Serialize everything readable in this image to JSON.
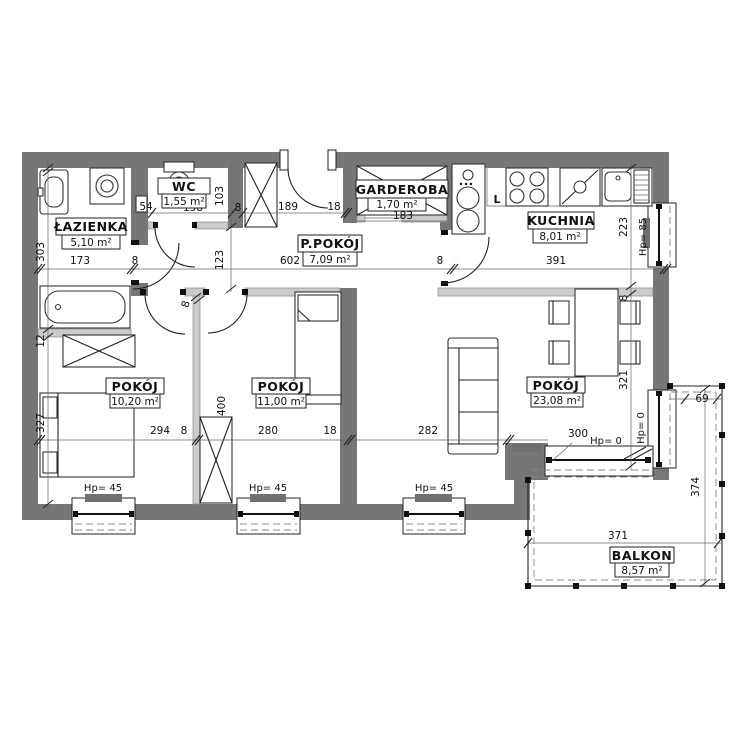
{
  "rooms": {
    "lazienka": {
      "name": "ŁAZIENKA",
      "area": "5,10 m²"
    },
    "wc": {
      "name": "WC",
      "area": "1,55 m²"
    },
    "garderoba": {
      "name": "GARDEROBA",
      "area": "1,70 m²"
    },
    "ppokoj": {
      "name": "P.POKÓJ",
      "area": "7,09 m²"
    },
    "kuchnia": {
      "name": "KUCHNIA",
      "area": "8,01 m²"
    },
    "pokoj1": {
      "name": "POKÓJ",
      "area": "10,20 m²"
    },
    "pokoj2": {
      "name": "POKÓJ",
      "area": "11,00 m²"
    },
    "pokoj3": {
      "name": "POKÓJ",
      "area": "23,08 m²"
    },
    "balkon": {
      "name": "BALKON",
      "area": "8,57 m²"
    }
  },
  "dims": {
    "bath_w": "173",
    "wall8": "8",
    "hall_w": "602",
    "kitchen_w": "391",
    "r1_w": "294",
    "r2_w": "280",
    "wall18": "18",
    "r3_w": "282",
    "balc_win_w": "300",
    "bath_h": "303",
    "wall12": "12",
    "r1_h": "327",
    "kitchen_h": "223",
    "r3_h": "321",
    "niche": "54",
    "wc_w": "158",
    "wc_h": "103",
    "hall_arm": "123",
    "entry_w": "189",
    "gard_w": "183",
    "r2_h": "400",
    "balc_side": "69",
    "balc_h": "374",
    "balc_w": "371"
  },
  "hp": {
    "hp45": "Hp= 45",
    "hp85": "Hp= 85",
    "hp0": "Hp= 0"
  },
  "kitchen": {
    "fridge": "L"
  },
  "colors": {
    "wall": "#767676",
    "partition": "#cbcbcb",
    "line": "#222222",
    "background": "#ffffff"
  }
}
